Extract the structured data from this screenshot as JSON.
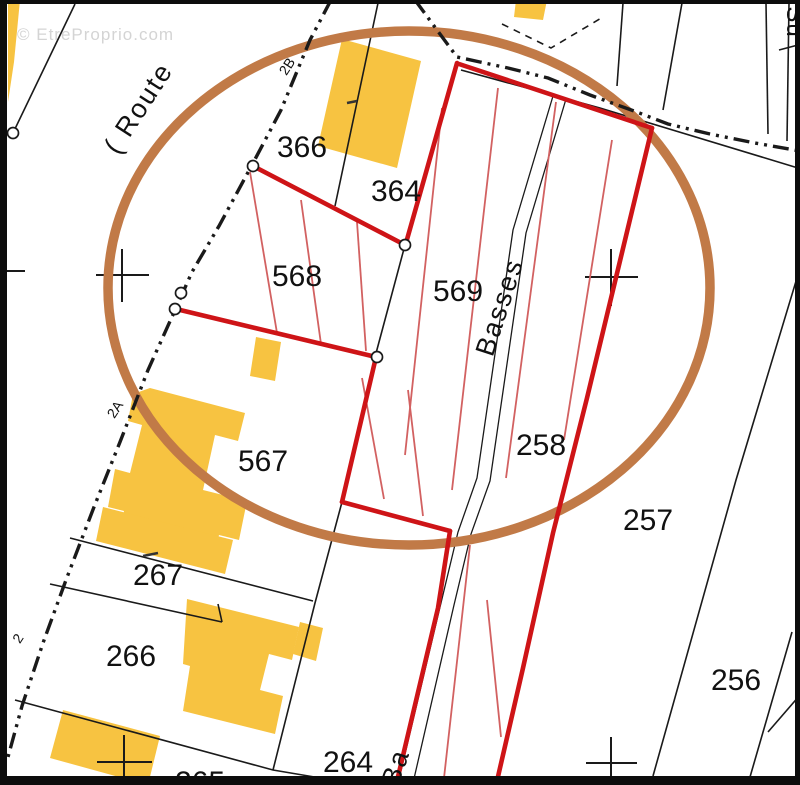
{
  "watermark": "© EtreProprio.com",
  "streets": {
    "route": "( Route",
    "basses": "Basses",
    "basses_fragment": "Ba",
    "side_street_fragment": "Su"
  },
  "road_markers": {
    "top": "2B",
    "middle": "2A",
    "bottom": "2"
  },
  "parcels": [
    {
      "number": "366"
    },
    {
      "number": "364"
    },
    {
      "number": "568"
    },
    {
      "number": "569"
    },
    {
      "number": "567"
    },
    {
      "number": "267"
    },
    {
      "number": "266"
    },
    {
      "number": "258"
    },
    {
      "number": "257"
    },
    {
      "number": "256"
    },
    {
      "number": "264"
    },
    {
      "number": "265"
    }
  ],
  "colors": {
    "background": "#FFFFFF",
    "building": "#F7C341",
    "outline_red": "#CE1417",
    "hatch_red": "#D26161",
    "circle_brown": "#C17A47",
    "line_black": "#1a1a1a",
    "label_black": "#111111",
    "watermark_gray": "#d4d4d4",
    "frame_black": "#0d0d0d"
  }
}
